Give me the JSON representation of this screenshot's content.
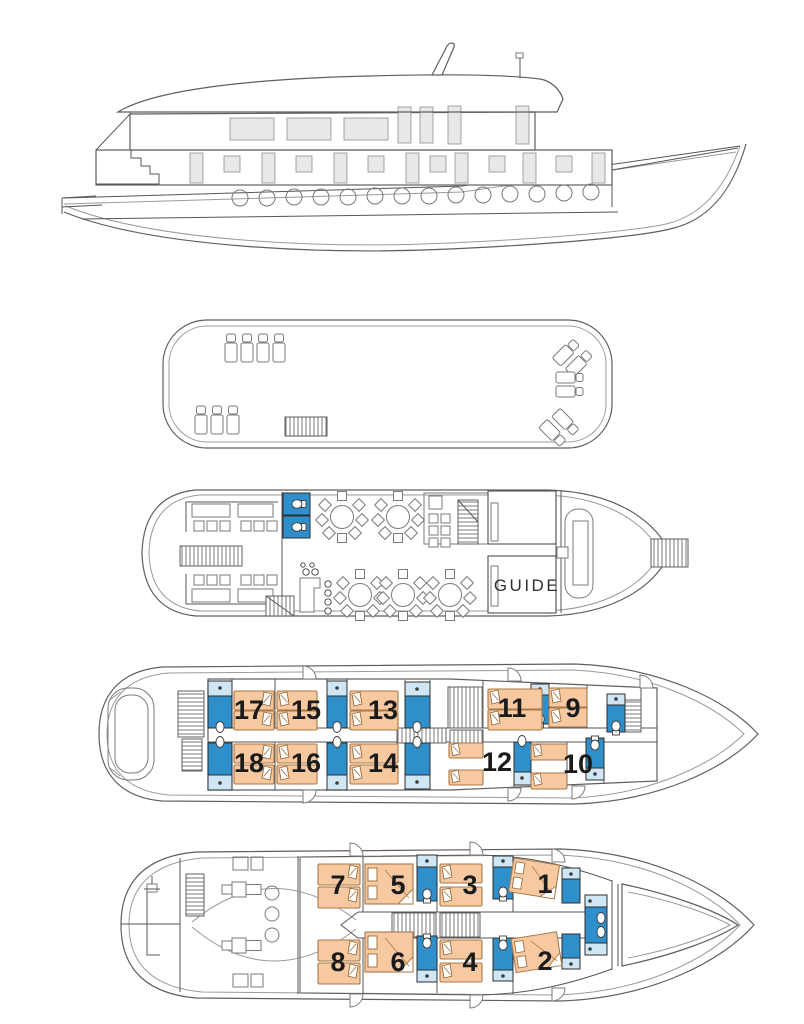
{
  "diagram": {
    "type": "ship-deck-plan",
    "views": [
      "side-profile",
      "sun-deck",
      "main-deck",
      "upper-cabin-deck",
      "lower-cabin-deck"
    ]
  },
  "colors": {
    "bathroom_blue": "#2f8fca",
    "bathroom_light_blue": "#cfe6f4",
    "bed_fill": "#f7c9a1",
    "bed_stroke": "#a87845",
    "outline_gray": "#5f5f5f",
    "window_gray": "#e8e8e8"
  },
  "main_deck": {
    "guide_label": "GUIDE"
  },
  "upper_cabin_deck": {
    "cabins": [
      {
        "number": "17"
      },
      {
        "number": "15"
      },
      {
        "number": "13"
      },
      {
        "number": "11"
      },
      {
        "number": "9"
      },
      {
        "number": "18"
      },
      {
        "number": "16"
      },
      {
        "number": "14"
      },
      {
        "number": "12"
      },
      {
        "number": "10"
      }
    ]
  },
  "lower_cabin_deck": {
    "cabins": [
      {
        "number": "7"
      },
      {
        "number": "5"
      },
      {
        "number": "3"
      },
      {
        "number": "1"
      },
      {
        "number": "8"
      },
      {
        "number": "6"
      },
      {
        "number": "4"
      },
      {
        "number": "2"
      }
    ]
  }
}
